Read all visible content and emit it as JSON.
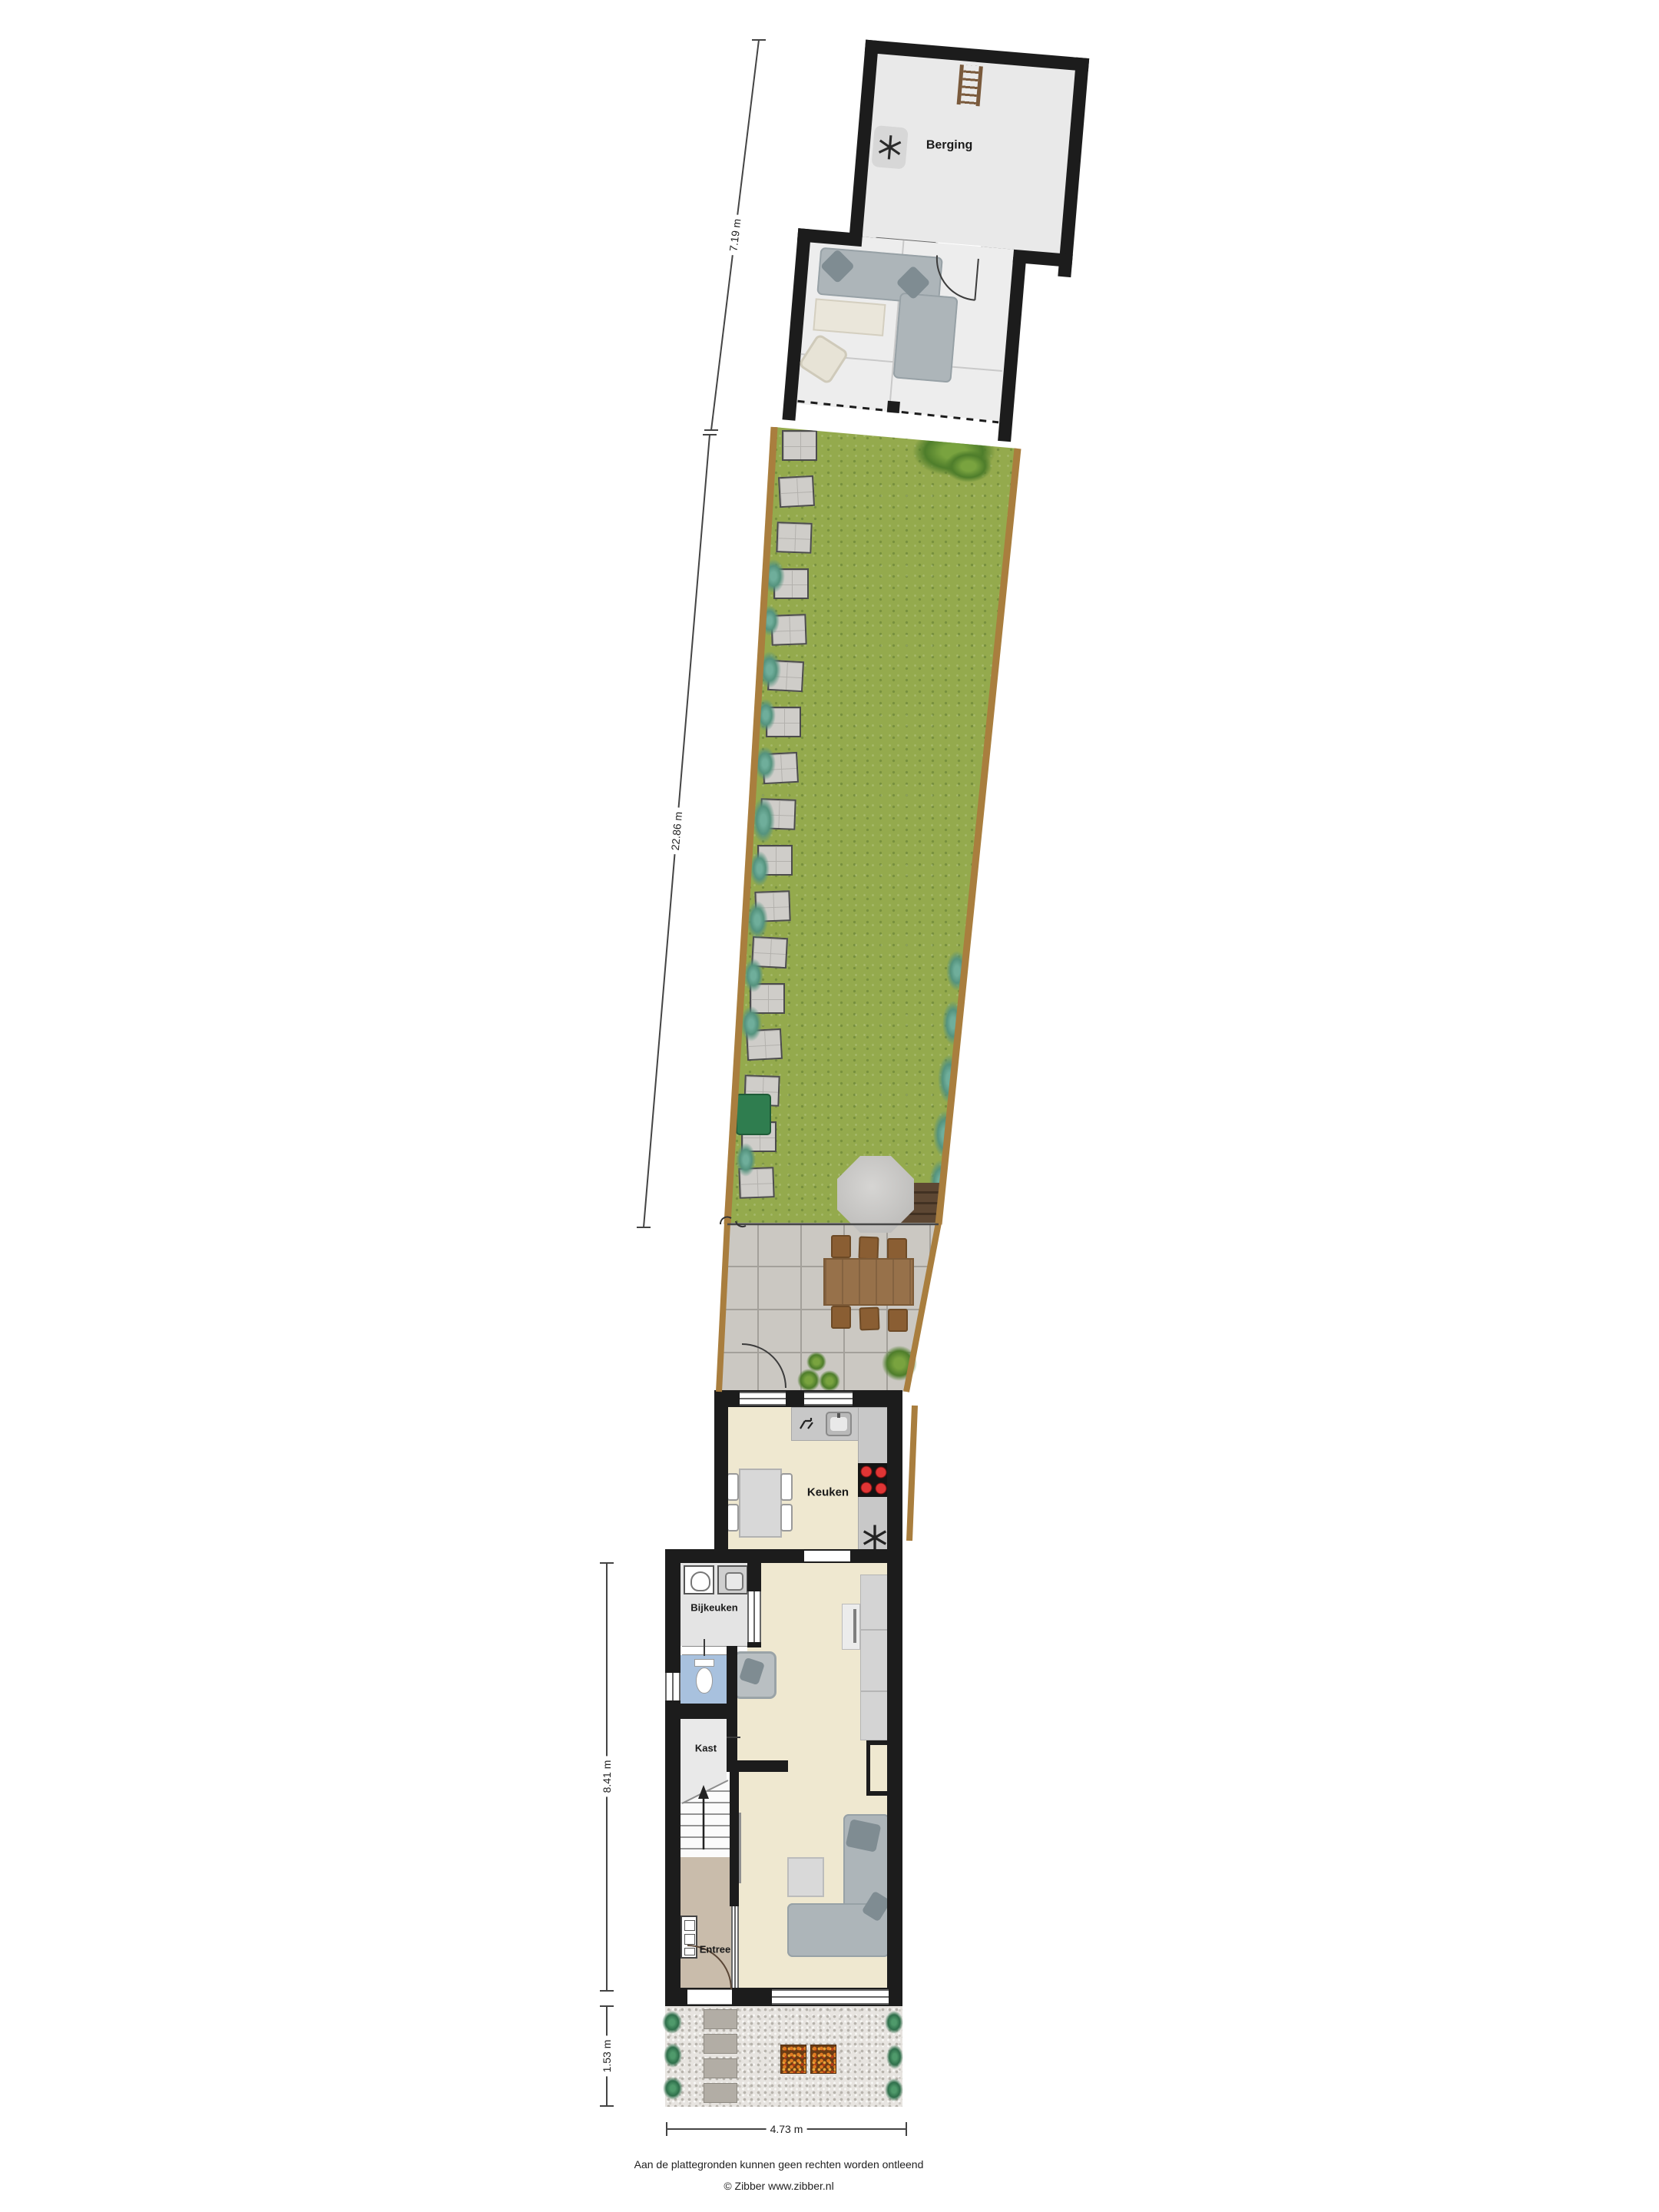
{
  "plan": {
    "rooms": {
      "berging": "Berging",
      "keuken": "Keuken",
      "bijkeuken": "Bijkeuken",
      "kast": "Kast",
      "entree": "Entree"
    },
    "dimensions": {
      "shed_depth": "7.19 m",
      "garden_length": "22.86 m",
      "house_depth": "8.41 m",
      "front_garden_depth": "1.53 m",
      "plot_width": "4.73 m"
    },
    "footer": {
      "disclaimer": "Aan de plattegronden kunnen geen rechten worden ontleend",
      "credit": "© Zibber www.zibber.nl"
    },
    "icons": {
      "fan": "fan-icon",
      "ladder": "ladder-icon",
      "washer": "washer-icon",
      "dryer": "dryer-icon",
      "toilet": "toilet-icon",
      "sink": "sink-icon",
      "faucet": "faucet-icon",
      "stove": "stove-icon",
      "meter_cabinet": "meter-cabinet-icon",
      "stairs_arrow": "stairs-up-arrow-icon"
    },
    "colors": {
      "wall": "#1c1c1c",
      "grass": "#94aa4d",
      "fence": "#a97e3e",
      "floor_main": "#efe8d0",
      "floor_toilet": "#a8c1de",
      "floor_entree": "#c9bcab",
      "patio_tile": "#cbc8c2",
      "deck": "#5d4733",
      "stove_burner": "#d23131"
    }
  }
}
